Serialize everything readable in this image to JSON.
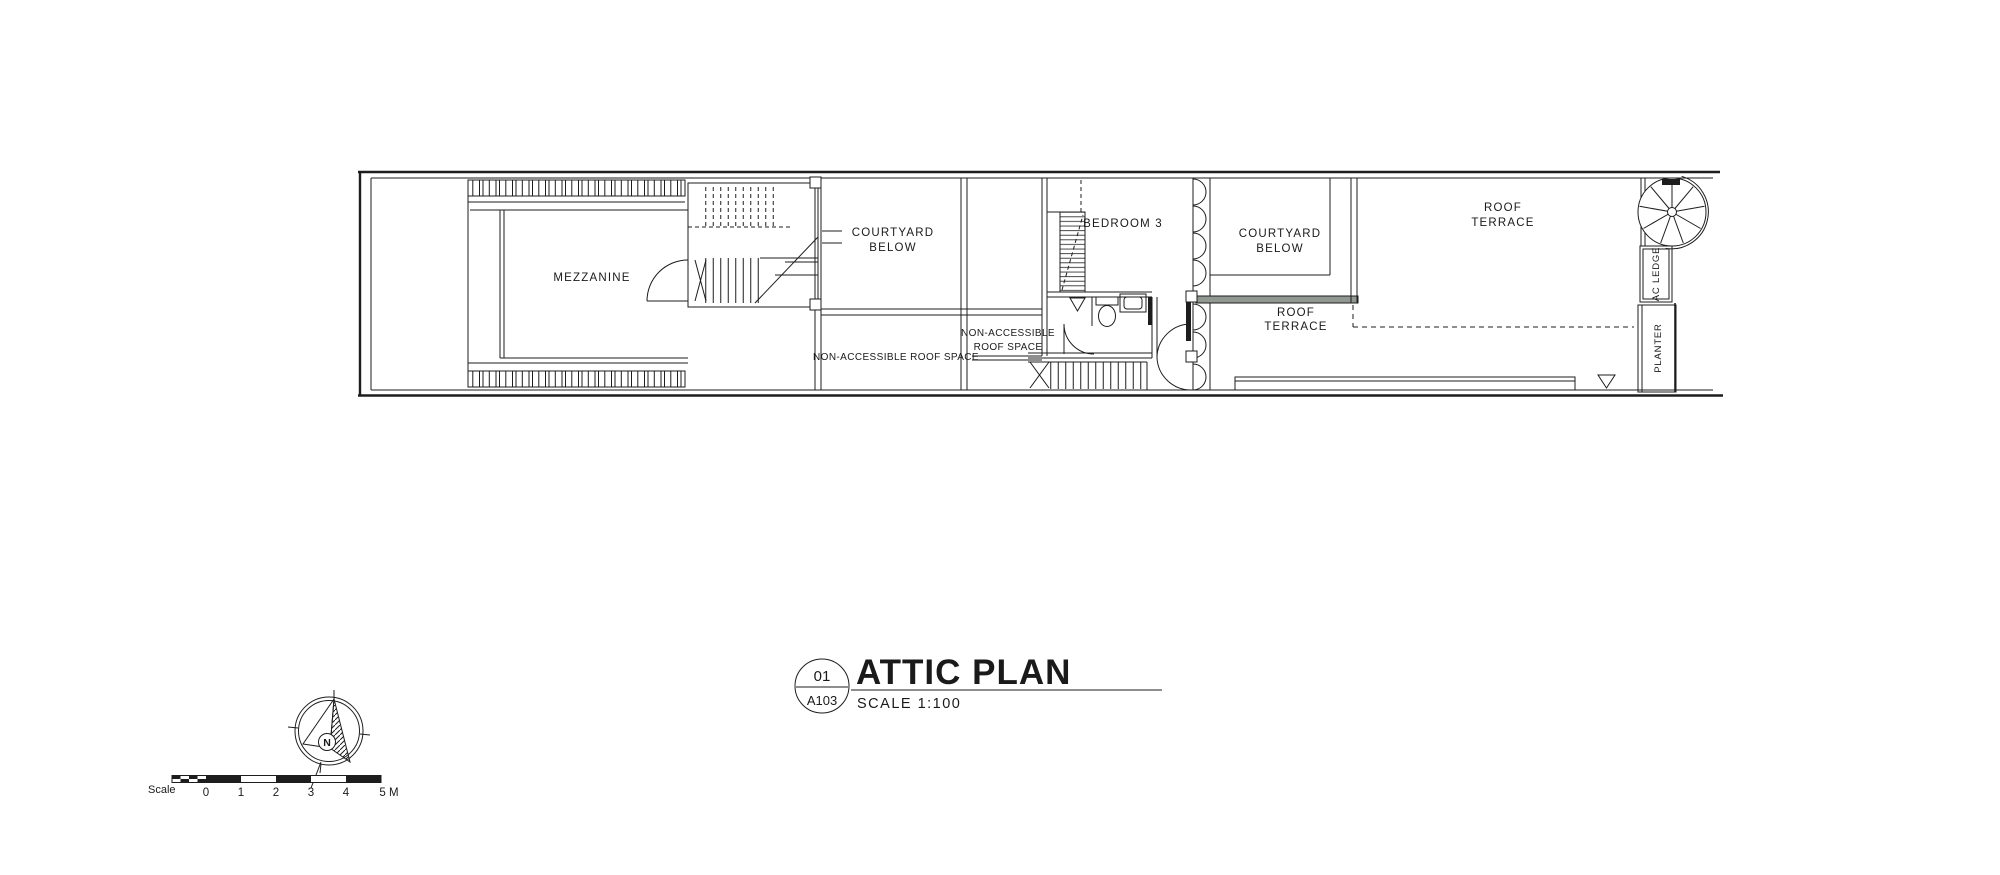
{
  "plan": {
    "labels": {
      "mezzanine": "MEZZANINE",
      "courtyard1_l1": "COURTYARD",
      "courtyard1_l2": "BELOW",
      "bedroom3": "BEDROOM 3",
      "roof_space_long": "NON-ACCESSIBLE ROOF SPACE",
      "roof_space_l1": "NON-ACCESSIBLE",
      "roof_space_l2": "ROOF SPACE",
      "courtyard2_l1": "COURTYARD",
      "courtyard2_l2": "BELOW",
      "terrace_mid_l1": "ROOF",
      "terrace_mid_l2": "TERRACE",
      "terrace_main_l1": "ROOF",
      "terrace_main_l2": "TERRACE",
      "ac_ledge": "AC LEDGE",
      "planter": "PLANTER"
    }
  },
  "title_block": {
    "detail_number": "01",
    "sheet_number": "A103",
    "title": "ATTIC PLAN",
    "scale": "SCALE 1:100"
  },
  "north_arrow": {
    "label": "N"
  },
  "scale_bar": {
    "label": "Scale",
    "ticks": [
      "0",
      "1",
      "2",
      "3",
      "4",
      "5 M"
    ]
  },
  "colors": {
    "line": "#1d1d1d",
    "terrace_band": "#919791",
    "paper": "#ffffff"
  }
}
